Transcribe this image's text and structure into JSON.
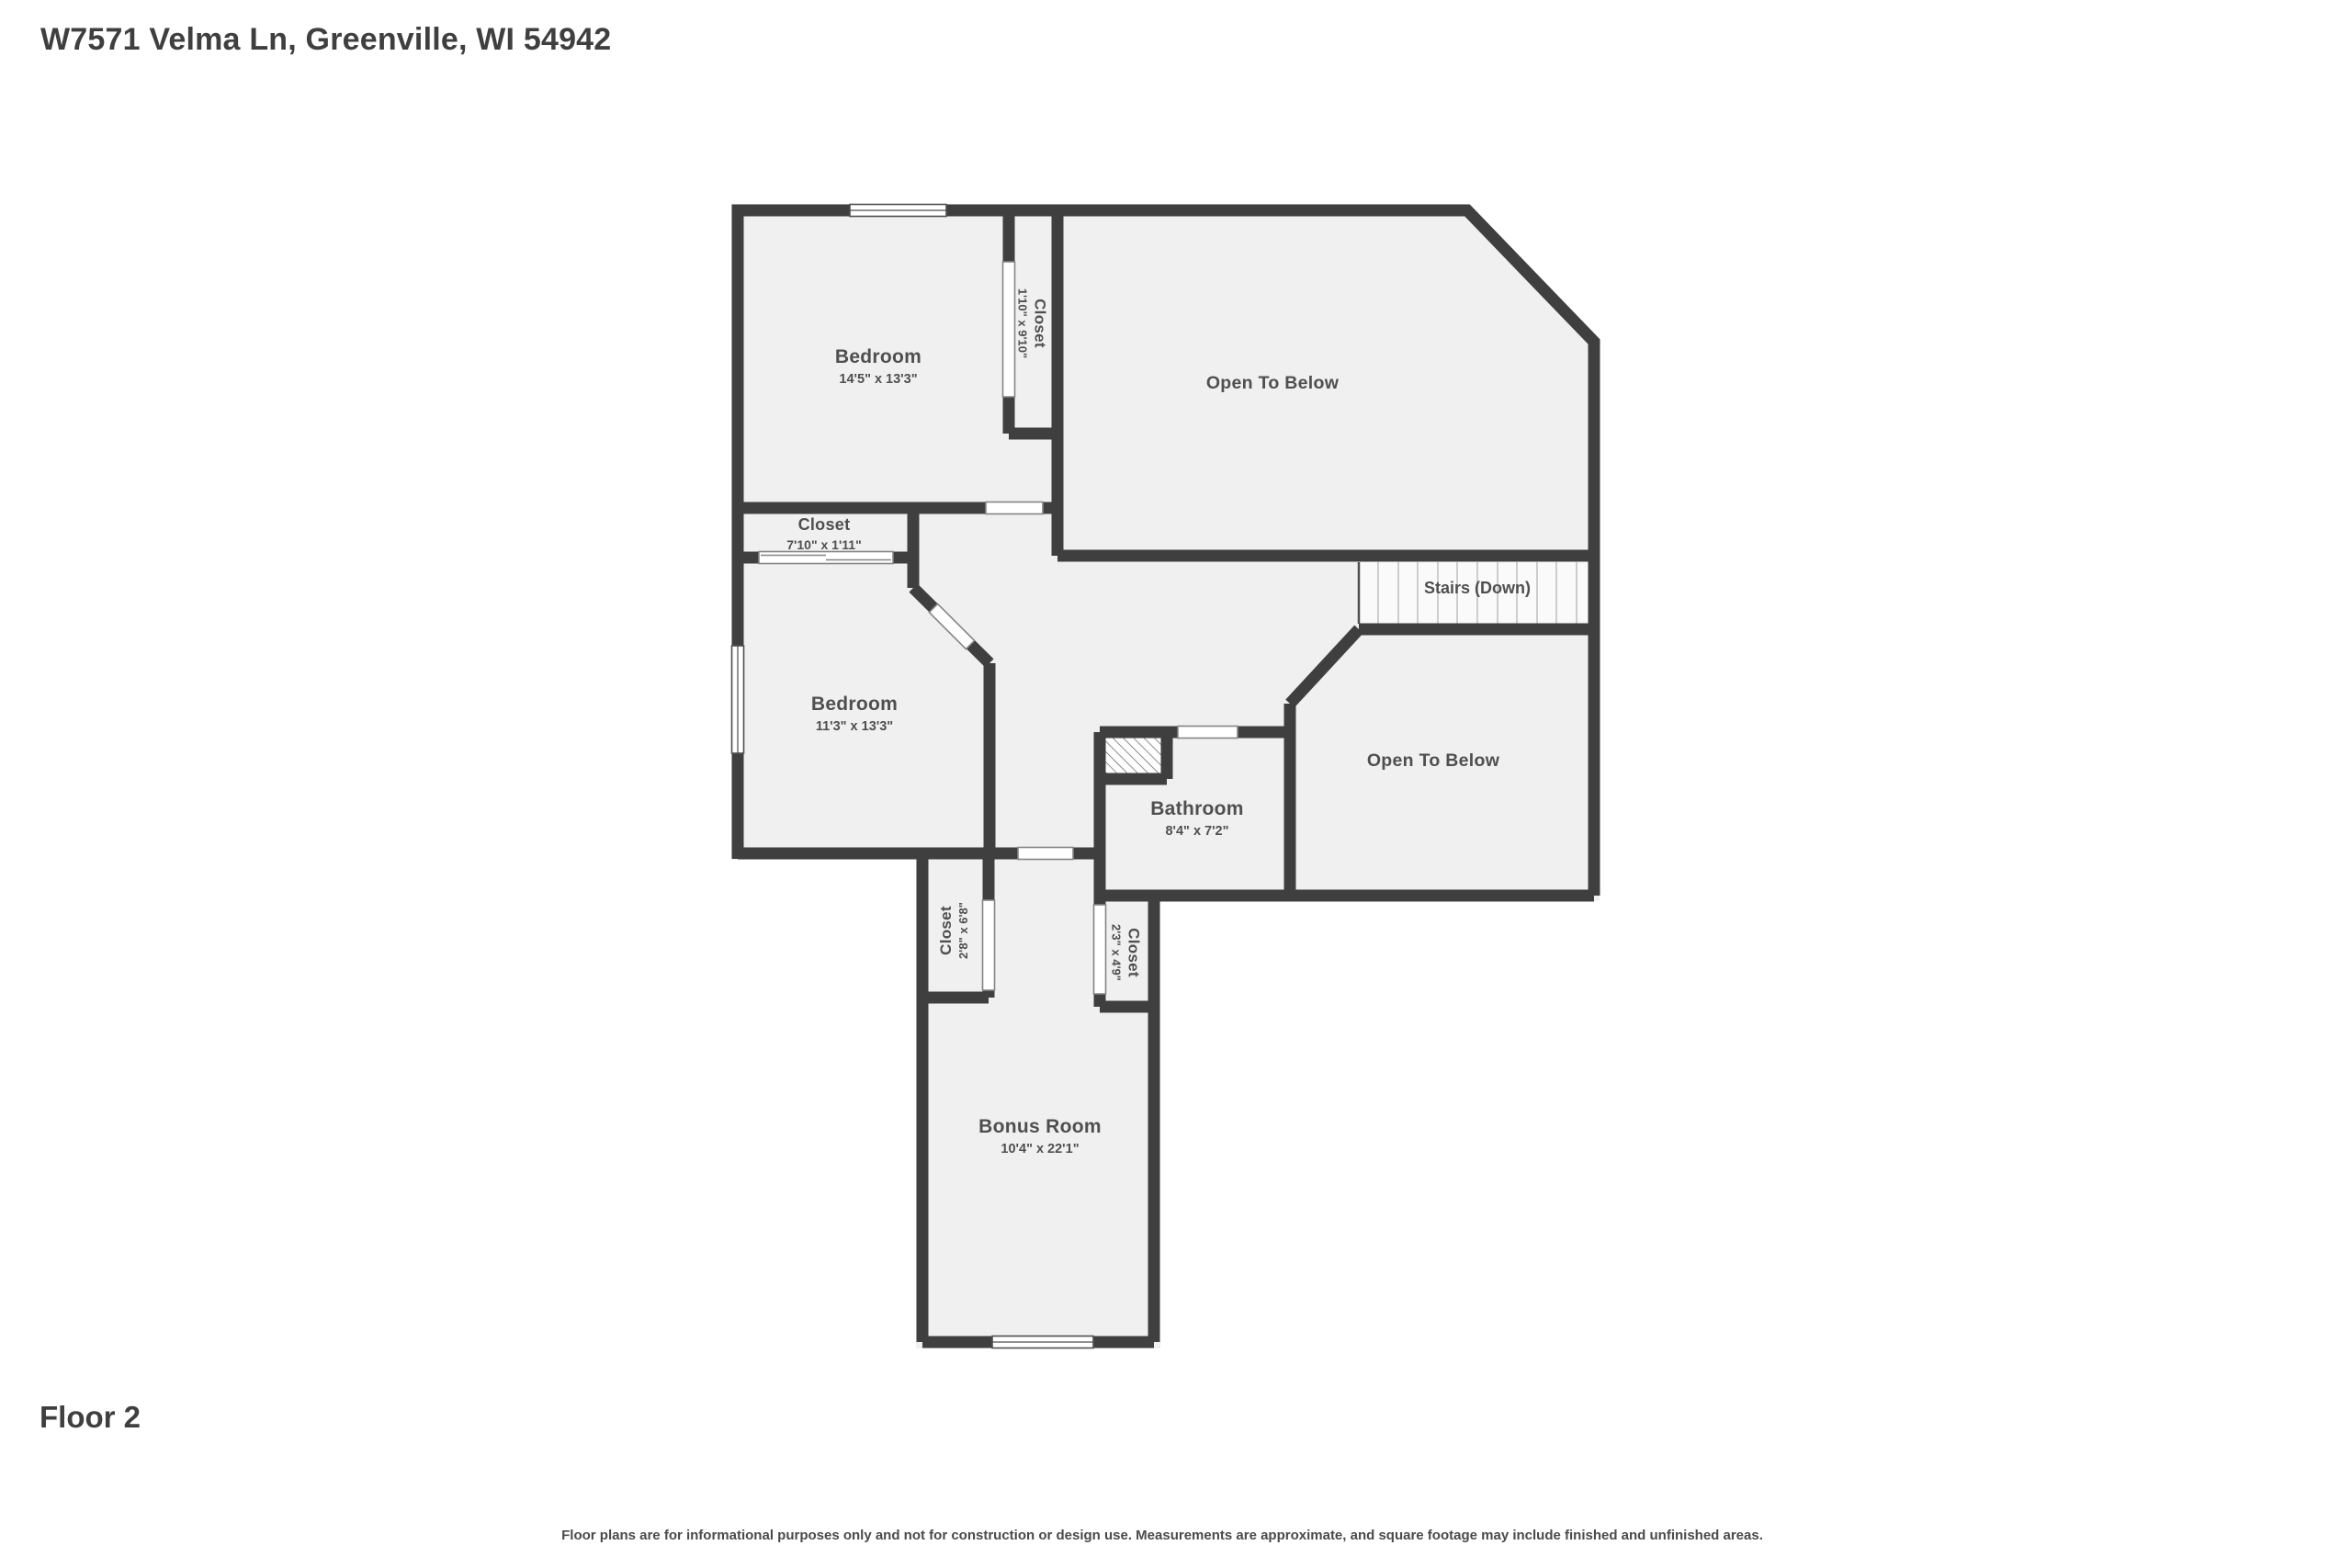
{
  "page": {
    "address": "W7571 Velma Ln, Greenville, WI 54942",
    "floor_label": "Floor 2",
    "disclaimer": "Floor plans are for informational purposes only and not for construction or design use. Measurements are approximate, and square footage may include finished and unfinished areas."
  },
  "colors": {
    "wall": "#3f3f3f",
    "room_fill": "#f0f0f0",
    "stairs_fill": "#fafafa",
    "label_text": "#4f4f4f",
    "title_text": "#3f3f3f"
  },
  "rooms": {
    "bedroom_top": {
      "name": "Bedroom",
      "dims": "14'5\" x 13'3\""
    },
    "closet_top": {
      "name": "Closet",
      "dims": "1'10\" x 9'10\""
    },
    "open_below_top": {
      "name": "Open To Below"
    },
    "closet_mid": {
      "name": "Closet",
      "dims": "7'10\" x 1'11\""
    },
    "bedroom_left": {
      "name": "Bedroom",
      "dims": "11'3\" x 13'3\""
    },
    "stairs": {
      "name": "Stairs (Down)"
    },
    "open_below_right": {
      "name": "Open To Below"
    },
    "bathroom": {
      "name": "Bathroom",
      "dims": "8'4\" x 7'2\""
    },
    "closet_hall_left": {
      "name": "Closet",
      "dims": "2'8\" x 6'8\""
    },
    "closet_hall_right": {
      "name": "Closet",
      "dims": "2'3\" x 4'9\""
    },
    "bonus_room": {
      "name": "Bonus Room",
      "dims": "10'4\" x 22'1\""
    }
  }
}
